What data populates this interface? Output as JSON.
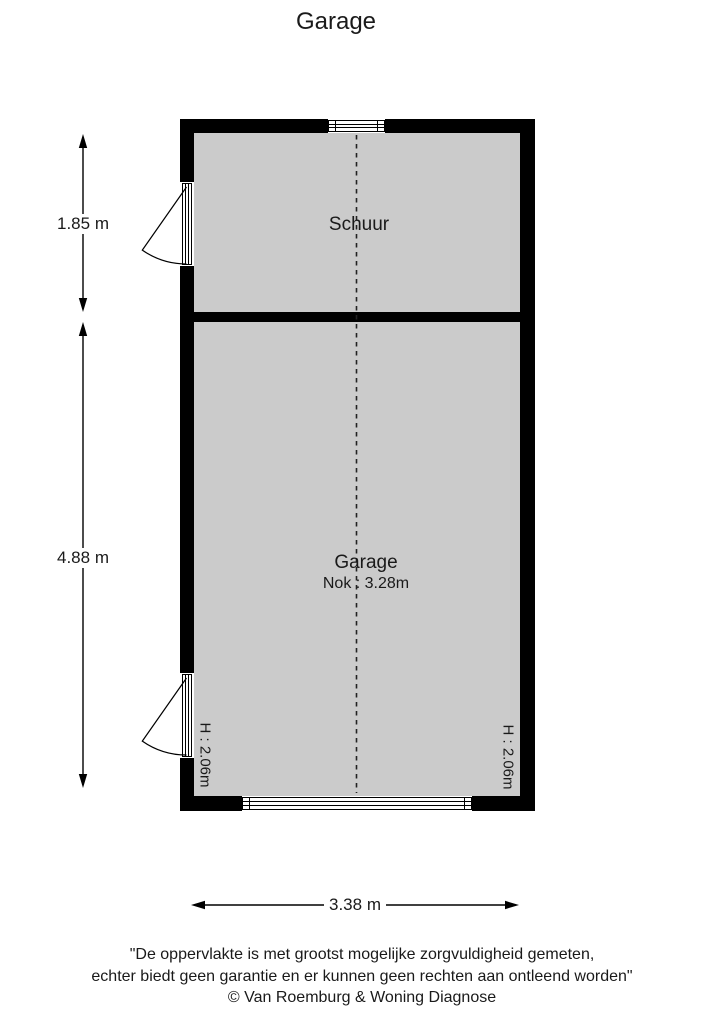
{
  "title": "Garage",
  "colors": {
    "wall": "#000000",
    "floor": "#cbcbcb",
    "background": "#ffffff",
    "line": "#000000"
  },
  "rooms": {
    "schuur": {
      "label": "Schuur"
    },
    "garage": {
      "label": "Garage",
      "ridge": "Nok : 3.28m"
    }
  },
  "dimensions": {
    "schuur_depth": "1.85 m",
    "garage_depth": "4.88 m",
    "total_width": "3.38 m",
    "door_height_left": "H : 2.06m",
    "door_height_right": "H : 2.06m"
  },
  "symbols": {
    "window": "window-icon",
    "entry_doors": "door-swing-icon",
    "garage_door": "garage-door-icon",
    "ridge": "ridge-dashed-line"
  },
  "footer": {
    "line1": "\"De oppervlakte is met grootst mogelijke zorgvuldigheid gemeten,",
    "line2": "echter biedt geen garantie en er kunnen geen rechten aan ontleend worden\"",
    "line3": "© Van Roemburg & Woning Diagnose"
  }
}
